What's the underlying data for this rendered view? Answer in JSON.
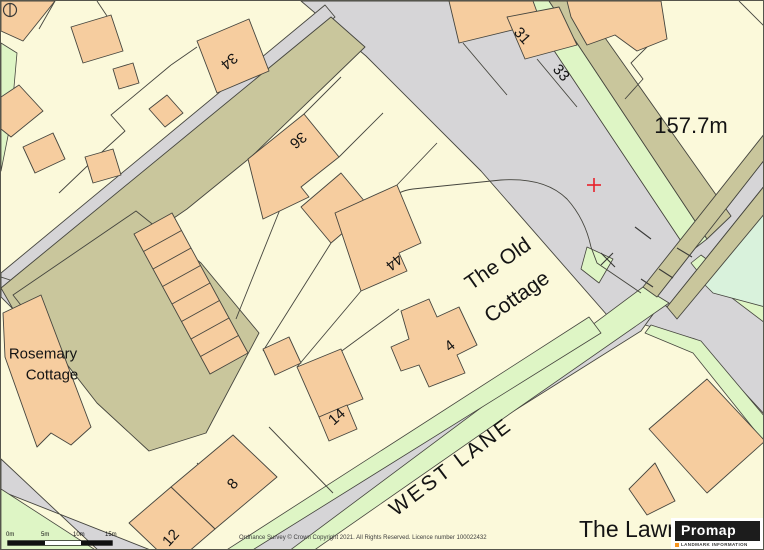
{
  "map": {
    "house_numbers": {
      "n34": "34",
      "n36": "36",
      "n44": "44",
      "n31": "31",
      "n33": "33",
      "n4": "4",
      "n14": "14",
      "n8": "8",
      "n12": "12"
    },
    "place_labels": {
      "spot_height": "157.7m",
      "old_cottage_line1": "The Old",
      "old_cottage_line2": "Cottage",
      "rosemary_line1": "Rosemary",
      "rosemary_line2": "Cottage",
      "west_lane": "WEST LANE",
      "the_lawns": "The Lawn"
    },
    "marker": {
      "shape": "plus",
      "color": "#e8212a"
    }
  },
  "scale_bar": {
    "ticks": [
      "0m",
      "5m",
      "10m",
      "15m"
    ]
  },
  "attribution": "Ordnance Survey © Crown Copyright 2021. All Rights Reserved. Licence number 100022432",
  "logo": {
    "brand": "Promap",
    "tagline": "LANDMARK INFORMATION",
    "accent": "#f7941d"
  },
  "colors": {
    "background": "#fbf9da",
    "building": "#f6cd9f",
    "building_light": "#fbf9da",
    "road": "#d6d5d7",
    "verge": "#c9c69c",
    "grass": "#def5c5",
    "grass_mint": "#d9f2dc",
    "outline": "#45453e",
    "marker_red": "#e8212a"
  }
}
